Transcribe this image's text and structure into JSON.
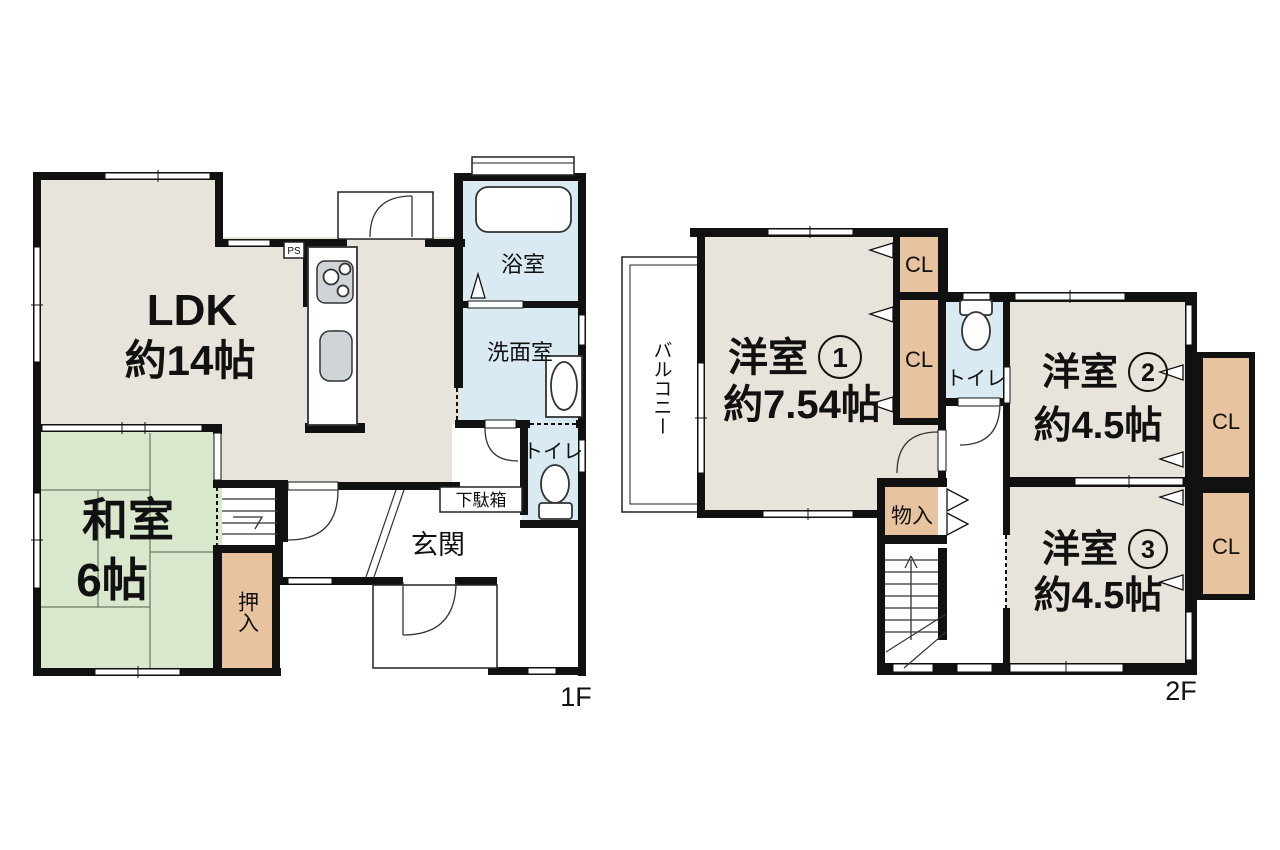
{
  "document_type": "japanese-floor-plan",
  "colors": {
    "wall": "#111111",
    "room_beige": "#e9e4db",
    "tatami_green": "#d9e7cc",
    "closet_tan": "#e8c3a0",
    "water_blue": "#daeaf3",
    "background": "#ffffff"
  },
  "floor_1f": {
    "floor_label": "1F",
    "rooms": {
      "ldk": {
        "name": "LDK",
        "size": "約14帖"
      },
      "washitsu": {
        "name": "和室",
        "size": "6帖"
      },
      "oshiire": {
        "name": "押入"
      },
      "bathroom": {
        "name": "浴室"
      },
      "washroom": {
        "name": "洗面室"
      },
      "toilet": {
        "name": "トイレ"
      },
      "getabako": {
        "name": "下駄箱"
      },
      "genkan": {
        "name": "玄関"
      },
      "pipe_space": {
        "name": "PS"
      }
    }
  },
  "floor_2f": {
    "floor_label": "2F",
    "rooms": {
      "western_room_1": {
        "name": "洋室",
        "number": "1",
        "label": "洋室①",
        "size": "約7.54帖"
      },
      "western_room_2": {
        "name": "洋室",
        "number": "2",
        "label": "洋室②",
        "size": "約4.5帖"
      },
      "western_room_3": {
        "name": "洋室",
        "number": "3",
        "label": "洋室③",
        "size": "約4.5帖"
      },
      "balcony": {
        "name": "バルコニー"
      },
      "toilet": {
        "name": "トイレ"
      },
      "storage": {
        "name": "物入"
      },
      "closet_label": "CL"
    }
  }
}
